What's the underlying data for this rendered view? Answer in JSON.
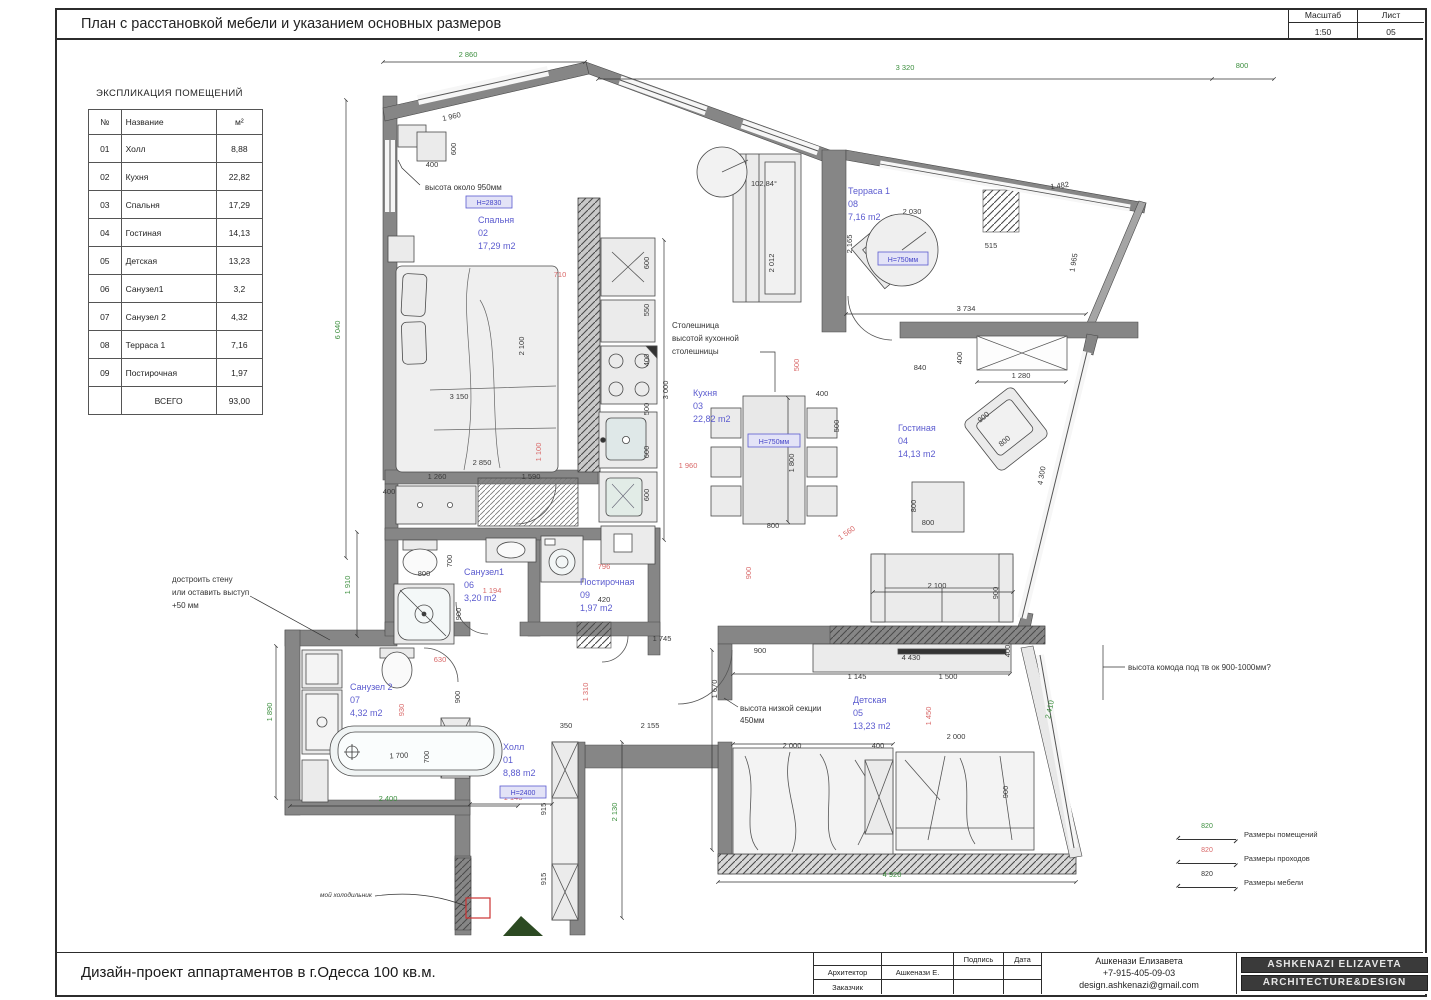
{
  "header": {
    "title": "План  с расстановкой мебели и указанием основных размеров",
    "scale_label": "Масштаб",
    "sheet_label": "Лист",
    "scale_value": "1:50",
    "sheet_value": "05"
  },
  "explication": {
    "heading": "ЭКСПЛИКАЦИЯ ПОМЕЩЕНИЙ",
    "headers": [
      "№",
      "Название",
      "м²"
    ],
    "rows": [
      [
        "01",
        "Холл",
        "8,88"
      ],
      [
        "02",
        "Кухня",
        "22,82"
      ],
      [
        "03",
        "Спальня",
        "17,29"
      ],
      [
        "04",
        "Гостиная",
        "14,13"
      ],
      [
        "05",
        "Детская",
        "13,23"
      ],
      [
        "06",
        "Санузел1",
        "3,2"
      ],
      [
        "07",
        "Санузел 2",
        "4,32"
      ],
      [
        "08",
        "Терраса 1",
        "7,16"
      ],
      [
        "09",
        "Постирочная",
        "1,97"
      ]
    ],
    "total_label": "ВСЕГО",
    "total_value": "93,00"
  },
  "plan": {
    "rooms": {
      "bedroom": {
        "name": "Спальня",
        "num": "02",
        "area": "17,29 m2",
        "tag": "Н=2830"
      },
      "kitchen": {
        "name": "Кухня",
        "num": "03",
        "area": "22,82 m2"
      },
      "living": {
        "name": "Гостиная",
        "num": "04",
        "area": "14,13 m2"
      },
      "terrace": {
        "name": "Терраса 1",
        "num": "08",
        "area": "7,16 m2"
      },
      "children": {
        "name": "Детская",
        "num": "05",
        "area": "13,23 m2"
      },
      "bath1": {
        "name": "Санузел1",
        "num": "06",
        "area": "3,20 m2"
      },
      "bath2": {
        "name": "Санузел 2",
        "num": "07",
        "area": "4,32 m2"
      },
      "laundry": {
        "name": "Постирочная",
        "num": "09",
        "area": "1,97 m2"
      },
      "hall": {
        "name": "Холл",
        "num": "01",
        "area": "8,88 m2",
        "tag": "Н=2400"
      }
    },
    "tags": {
      "dining_table": "Н=750мм",
      "terrace_table": "Н=750мм"
    },
    "annotations": {
      "nightstand": [
        "высота около 950мм"
      ],
      "countertop": [
        "Столешница",
        "высотой кухонной",
        "столешницы"
      ],
      "wall": [
        "достроить стену",
        "или оставить выступ",
        "+50 мм"
      ],
      "low_section": [
        "высота низкой секции",
        "450мм"
      ],
      "tv": [
        "высота комода под тв ок 900-1000мм?"
      ],
      "fridge": [
        "мой холодильник"
      ],
      "angle": "102,84°"
    },
    "dims": [
      {
        "t": "2 860",
        "x": 468,
        "y": 57,
        "rot": 0,
        "c": "g"
      },
      {
        "t": "3 320",
        "x": 905,
        "y": 70,
        "rot": 0,
        "c": "g"
      },
      {
        "t": "800",
        "x": 1242,
        "y": 68,
        "rot": 0,
        "c": "g"
      },
      {
        "t": "6 040",
        "x": 340,
        "y": 330,
        "rot": -90,
        "c": "g"
      },
      {
        "t": "1 910",
        "x": 350,
        "y": 585,
        "rot": -90,
        "c": "g"
      },
      {
        "t": "1 890",
        "x": 272,
        "y": 712,
        "rot": -90,
        "c": "g"
      },
      {
        "t": "2 400",
        "x": 388,
        "y": 801,
        "rot": 0,
        "c": "g"
      },
      {
        "t": "2 130",
        "x": 617,
        "y": 812,
        "rot": -90,
        "c": "g"
      },
      {
        "t": "4 920",
        "x": 892,
        "y": 877,
        "rot": 0,
        "c": "g"
      },
      {
        "t": "2 410",
        "x": 1052,
        "y": 710,
        "rot": -78,
        "c": "g"
      },
      {
        "t": "710",
        "x": 560,
        "y": 277,
        "rot": 0,
        "c": "r"
      },
      {
        "t": "1 100",
        "x": 541,
        "y": 452,
        "rot": -90,
        "c": "r"
      },
      {
        "t": "1 960",
        "x": 688,
        "y": 468,
        "rot": 0,
        "c": "r"
      },
      {
        "t": "500",
        "x": 799,
        "y": 365,
        "rot": -90,
        "c": "r"
      },
      {
        "t": "900",
        "x": 751,
        "y": 573,
        "rot": -90,
        "c": "r"
      },
      {
        "t": "1 560",
        "x": 848,
        "y": 535,
        "rot": -35,
        "c": "r"
      },
      {
        "t": "1 194",
        "x": 492,
        "y": 593,
        "rot": 0,
        "c": "r"
      },
      {
        "t": "796",
        "x": 604,
        "y": 569,
        "rot": 0,
        "c": "r"
      },
      {
        "t": "630",
        "x": 440,
        "y": 662,
        "rot": 0,
        "c": "r"
      },
      {
        "t": "930",
        "x": 404,
        "y": 710,
        "rot": -90,
        "c": "r"
      },
      {
        "t": "1 140",
        "x": 513,
        "y": 800,
        "rot": 0,
        "c": "r"
      },
      {
        "t": "1 310",
        "x": 588,
        "y": 692,
        "rot": -90,
        "c": "r"
      },
      {
        "t": "1 450",
        "x": 931,
        "y": 716,
        "rot": -90,
        "c": "r"
      },
      {
        "t": "1 960",
        "x": 452,
        "y": 119,
        "rot": -13,
        "c": "k"
      },
      {
        "t": "400",
        "x": 432,
        "y": 167,
        "rot": 0,
        "c": "k"
      },
      {
        "t": "600",
        "x": 456,
        "y": 149,
        "rot": -90,
        "c": "k"
      },
      {
        "t": "400",
        "x": 389,
        "y": 494,
        "rot": 0,
        "c": "k"
      },
      {
        "t": "2 100",
        "x": 524,
        "y": 346,
        "rot": -90,
        "c": "k"
      },
      {
        "t": "3 150",
        "x": 459,
        "y": 399,
        "rot": 0,
        "c": "k"
      },
      {
        "t": "1 260",
        "x": 437,
        "y": 479,
        "rot": 0,
        "c": "k"
      },
      {
        "t": "1 590",
        "x": 531,
        "y": 479,
        "rot": 0,
        "c": "k"
      },
      {
        "t": "2 850",
        "x": 482,
        "y": 465,
        "rot": 0,
        "c": "k"
      },
      {
        "t": "3 000",
        "x": 668,
        "y": 390,
        "rot": -90,
        "c": "k"
      },
      {
        "t": "600",
        "x": 649,
        "y": 263,
        "rot": -90,
        "c": "k"
      },
      {
        "t": "550",
        "x": 649,
        "y": 310,
        "rot": -90,
        "c": "k"
      },
      {
        "t": "400",
        "x": 649,
        "y": 360,
        "rot": -90,
        "c": "k"
      },
      {
        "t": "500",
        "x": 649,
        "y": 409,
        "rot": -90,
        "c": "k"
      },
      {
        "t": "600",
        "x": 649,
        "y": 452,
        "rot": -90,
        "c": "k"
      },
      {
        "t": "600",
        "x": 649,
        "y": 495,
        "rot": -90,
        "c": "k"
      },
      {
        "t": "1 800",
        "x": 794,
        "y": 463,
        "rot": -90,
        "c": "k"
      },
      {
        "t": "800",
        "x": 773,
        "y": 528,
        "rot": 0,
        "c": "k"
      },
      {
        "t": "400",
        "x": 822,
        "y": 396,
        "rot": 0,
        "c": "k"
      },
      {
        "t": "500",
        "x": 839,
        "y": 426,
        "rot": -90,
        "c": "k"
      },
      {
        "t": "102,84°",
        "x": 764,
        "y": 186,
        "rot": 0,
        "c": "k"
      },
      {
        "t": "2 012",
        "x": 774,
        "y": 263,
        "rot": -90,
        "c": "k"
      },
      {
        "t": "2 030",
        "x": 912,
        "y": 214,
        "rot": 0,
        "c": "k"
      },
      {
        "t": "1 482",
        "x": 1060,
        "y": 188,
        "rot": -8,
        "c": "k"
      },
      {
        "t": "515",
        "x": 991,
        "y": 248,
        "rot": 0,
        "c": "k"
      },
      {
        "t": "1 965",
        "x": 1076,
        "y": 263,
        "rot": -80,
        "c": "k"
      },
      {
        "t": "3 734",
        "x": 966,
        "y": 311,
        "rot": 0,
        "c": "k"
      },
      {
        "t": "2 165",
        "x": 852,
        "y": 244,
        "rot": -90,
        "c": "k"
      },
      {
        "t": "840",
        "x": 920,
        "y": 370,
        "rot": 0,
        "c": "k"
      },
      {
        "t": "400",
        "x": 962,
        "y": 358,
        "rot": -90,
        "c": "k"
      },
      {
        "t": "1 280",
        "x": 1021,
        "y": 378,
        "rot": 0,
        "c": "k"
      },
      {
        "t": "900",
        "x": 985,
        "y": 419,
        "rot": -40,
        "c": "k"
      },
      {
        "t": "800",
        "x": 1006,
        "y": 443,
        "rot": -40,
        "c": "k"
      },
      {
        "t": "800",
        "x": 928,
        "y": 525,
        "rot": 0,
        "c": "k"
      },
      {
        "t": "800",
        "x": 916,
        "y": 506,
        "rot": -90,
        "c": "k"
      },
      {
        "t": "2 100",
        "x": 937,
        "y": 588,
        "rot": 0,
        "c": "k"
      },
      {
        "t": "900",
        "x": 998,
        "y": 593,
        "rot": -90,
        "c": "k"
      },
      {
        "t": "4 300",
        "x": 1044,
        "y": 476,
        "rot": -80,
        "c": "k"
      },
      {
        "t": "900",
        "x": 760,
        "y": 653,
        "rot": 0,
        "c": "k"
      },
      {
        "t": "4 430",
        "x": 911,
        "y": 660,
        "rot": 0,
        "c": "k"
      },
      {
        "t": "1 145",
        "x": 857,
        "y": 679,
        "rot": 0,
        "c": "k"
      },
      {
        "t": "1 500",
        "x": 948,
        "y": 679,
        "rot": 0,
        "c": "k"
      },
      {
        "t": "400",
        "x": 1010,
        "y": 651,
        "rot": -90,
        "c": "k"
      },
      {
        "t": "2 000",
        "x": 792,
        "y": 748,
        "rot": 0,
        "c": "k"
      },
      {
        "t": "400",
        "x": 878,
        "y": 748,
        "rot": 0,
        "c": "k"
      },
      {
        "t": "2 000",
        "x": 956,
        "y": 739,
        "rot": 0,
        "c": "k"
      },
      {
        "t": "900",
        "x": 1008,
        "y": 792,
        "rot": -90,
        "c": "k"
      },
      {
        "t": "1 670",
        "x": 717,
        "y": 689,
        "rot": -90,
        "c": "k"
      },
      {
        "t": "2 155",
        "x": 650,
        "y": 728,
        "rot": 0,
        "c": "k"
      },
      {
        "t": "350",
        "x": 566,
        "y": 728,
        "rot": 0,
        "c": "k"
      },
      {
        "t": "915",
        "x": 546,
        "y": 809,
        "rot": -90,
        "c": "k"
      },
      {
        "t": "915",
        "x": 546,
        "y": 879,
        "rot": -90,
        "c": "k"
      },
      {
        "t": "800",
        "x": 424,
        "y": 576,
        "rot": 0,
        "c": "k"
      },
      {
        "t": "700",
        "x": 452,
        "y": 561,
        "rot": -90,
        "c": "k"
      },
      {
        "t": "900",
        "x": 461,
        "y": 614,
        "rot": -90,
        "c": "k"
      },
      {
        "t": "420",
        "x": 604,
        "y": 602,
        "rot": 0,
        "c": "k"
      },
      {
        "t": "1 700",
        "x": 399,
        "y": 758,
        "rot": -3,
        "c": "k"
      },
      {
        "t": "700",
        "x": 429,
        "y": 757,
        "rot": -90,
        "c": "k"
      },
      {
        "t": "900",
        "x": 460,
        "y": 697,
        "rot": -90,
        "c": "k"
      },
      {
        "t": "1 745",
        "x": 662,
        "y": 641,
        "rot": 0,
        "c": "k"
      }
    ]
  },
  "legend": {
    "items": [
      {
        "value": "820",
        "label": "Размеры помещений"
      },
      {
        "value": "820",
        "label": "Размеры проходов"
      },
      {
        "value": "820",
        "label": "Размеры мебели"
      }
    ]
  },
  "titleblock": {
    "sign_label": "Подпись",
    "date_label": "Дата",
    "architect_label": "Архитектор",
    "architect_name": "Ашкенази Е.",
    "client_label": "Заказчик",
    "contact_name": "Ашкенази Елизавета",
    "contact_phone": "+7-915-405-09-03",
    "contact_email": "design.ashkenazi@gmail.com",
    "badge1": "ASHKENAZI ELIZAVETA",
    "badge2": "ARCHITECTURE&DESIGN"
  },
  "footer": {
    "project_title": "Дизайн-проект аппартаментов в г.Одесса 100 кв.м."
  }
}
